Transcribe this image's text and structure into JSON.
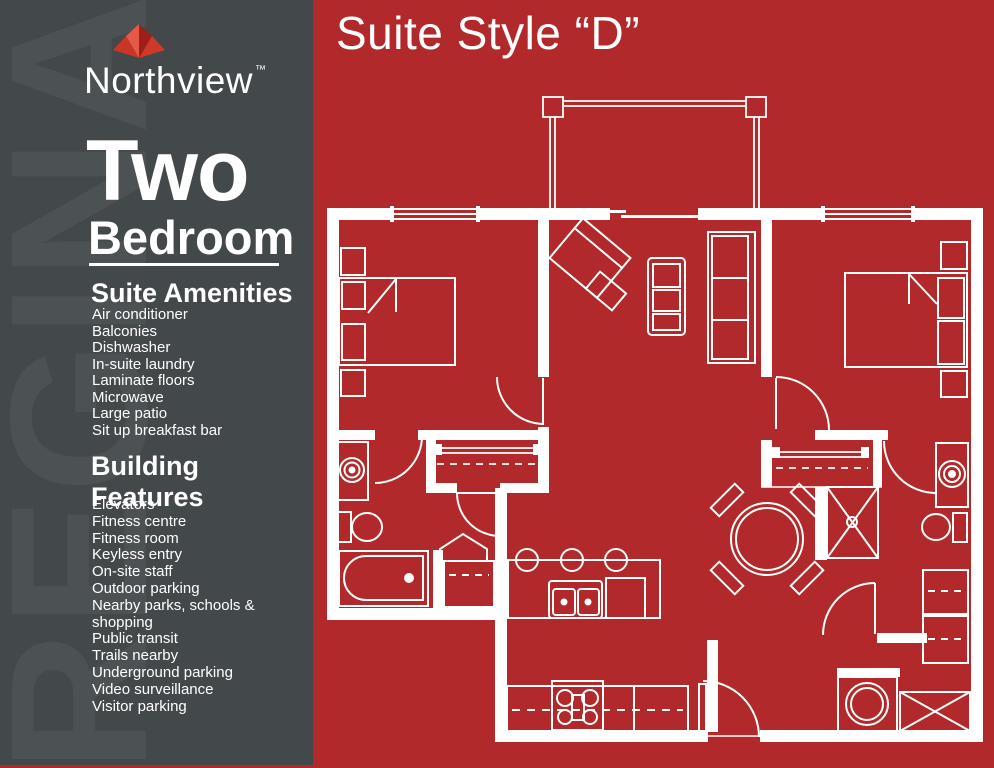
{
  "colors": {
    "background_red": "#b1292a",
    "sidebar_gray": "#43484a",
    "line_white": "#ffffff",
    "leaf_reds": [
      "#c93527",
      "#e65847",
      "#9e1f19",
      "#d0382a"
    ]
  },
  "watermark": "REGINA",
  "brand": {
    "name": "Northview",
    "trademark": "™",
    "logo_icon": "maple-leaf-icon"
  },
  "suite": {
    "title_line1": "Two",
    "title_line2": "Bedroom"
  },
  "plan": {
    "title": "Suite Style “D”"
  },
  "amenities": {
    "heading": "Suite Amenities",
    "items": [
      "Air conditioner",
      "Balconies",
      "Dishwasher",
      "In-suite laundry",
      "Laminate floors",
      "Microwave",
      "Large patio",
      "Sit up breakfast bar"
    ]
  },
  "features": {
    "heading": "Building Features",
    "items": [
      "Elevators",
      "Fitness centre",
      "Fitness room",
      "Keyless entry",
      "On-site staff",
      "Outdoor parking",
      "Nearby parks, schools & shopping",
      "Public transit",
      "Trails nearby",
      "Underground parking",
      "Video surveillance",
      "Visitor parking"
    ]
  },
  "floorplan": {
    "description": "two-bedroom suite floor plan drawing",
    "depicted_elements": [
      "balcony with posts and railing",
      "bedroom 1 bed with pillows and nightstands",
      "bedroom 2 bed with pillows and nightstands",
      "angled sofa chair and side table",
      "coffee table",
      "media shelf unit",
      "wardrobe closets with hanging rods",
      "corner pantry",
      "bathtub",
      "toilets",
      "washer and dryer",
      "shower stall",
      "bathroom sinks",
      "kitchen double sink",
      "dishwasher",
      "stove with four burners",
      "breakfast bar with three stools",
      "round dining table with four chairs",
      "entry door swing",
      "windows and sliding patio door"
    ]
  }
}
